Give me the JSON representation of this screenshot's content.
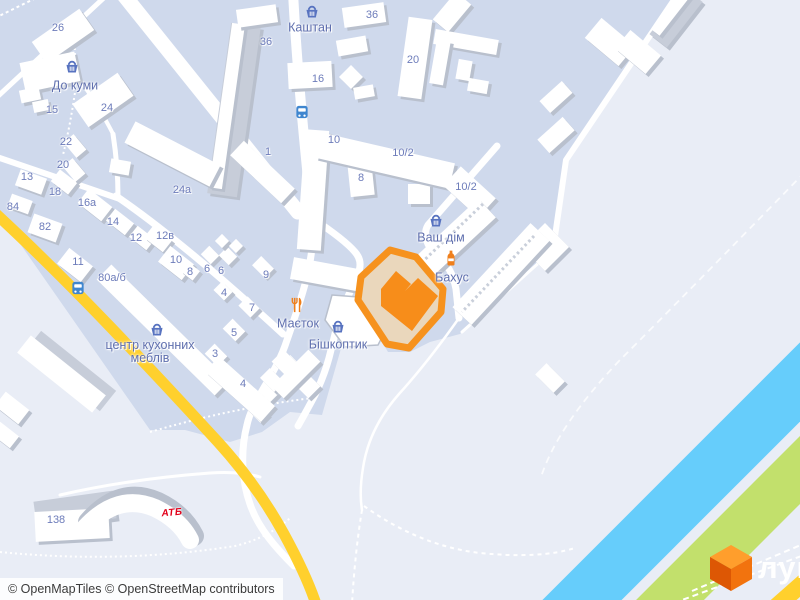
{
  "map": {
    "attribution": "© OpenMapTiles © OpenStreetMap contributors",
    "brand": {
      "logo_text": "лун",
      "logo_icon": "lun-cube-icon"
    },
    "colors": {
      "highlight_outline": "#f6921e",
      "highlight_building": "#f78d1a",
      "highlight_fill": "#ead7bc",
      "river": "#66cdfb",
      "greenery": "#c2e06c",
      "road_primary_yellow": "#ffd02d",
      "residential": "#cfd9ec",
      "background": "#e9edf6",
      "poi_blue": "#5873c0",
      "poi_orange": "#ef7f1b",
      "atb_red": "#e2001a"
    },
    "pois": [
      {
        "id": "kashtan",
        "lines": [
          "Каштан"
        ],
        "icon": "basket",
        "lx": 310,
        "ly": 28,
        "ix": 312,
        "iy": 12
      },
      {
        "id": "do-kumy",
        "lines": [
          "До куми"
        ],
        "icon": "basket",
        "lx": 75,
        "ly": 86,
        "ix": 72,
        "iy": 67
      },
      {
        "id": "vash-dim",
        "lines": [
          "Ваш дім"
        ],
        "icon": "basket",
        "lx": 441,
        "ly": 238,
        "ix": 436,
        "iy": 221
      },
      {
        "id": "bakhus",
        "lines": [
          "Бахус"
        ],
        "icon": "bottle",
        "lx": 452,
        "ly": 278,
        "ix": 451,
        "iy": 258
      },
      {
        "id": "maietok",
        "lines": [
          "Маєток"
        ],
        "icon": "restaurant",
        "lx": 298,
        "ly": 324,
        "ix": 297,
        "iy": 305
      },
      {
        "id": "bishkoptyk",
        "lines": [
          "Бішкоптик"
        ],
        "icon": "basket",
        "lx": 338,
        "ly": 345,
        "ix": 338,
        "iy": 327
      },
      {
        "id": "kitchen-center",
        "lines": [
          "центр кухонних",
          "меблів"
        ],
        "icon": "basket",
        "lx": 150,
        "ly": 352,
        "ix": 157,
        "iy": 330
      }
    ],
    "house_numbers": [
      {
        "t": "26",
        "x": 58,
        "y": 28
      },
      {
        "t": "36",
        "x": 266,
        "y": 42
      },
      {
        "t": "36",
        "x": 372,
        "y": 15
      },
      {
        "t": "24",
        "x": 107,
        "y": 108
      },
      {
        "t": "15",
        "x": 52,
        "y": 110
      },
      {
        "t": "16",
        "x": 318,
        "y": 79
      },
      {
        "t": "20",
        "x": 413,
        "y": 60
      },
      {
        "t": "10",
        "x": 334,
        "y": 140
      },
      {
        "t": "10/2",
        "x": 403,
        "y": 153
      },
      {
        "t": "10/2",
        "x": 466,
        "y": 187
      },
      {
        "t": "8",
        "x": 361,
        "y": 178
      },
      {
        "t": "22",
        "x": 66,
        "y": 142
      },
      {
        "t": "20",
        "x": 63,
        "y": 165
      },
      {
        "t": "13",
        "x": 27,
        "y": 177
      },
      {
        "t": "18",
        "x": 55,
        "y": 192
      },
      {
        "t": "16а",
        "x": 87,
        "y": 203
      },
      {
        "t": "84",
        "x": 13,
        "y": 207
      },
      {
        "t": "82",
        "x": 45,
        "y": 227
      },
      {
        "t": "14",
        "x": 113,
        "y": 222
      },
      {
        "t": "24а",
        "x": 182,
        "y": 190
      },
      {
        "t": "1",
        "x": 268,
        "y": 152
      },
      {
        "t": "12",
        "x": 136,
        "y": 238
      },
      {
        "t": "12в",
        "x": 165,
        "y": 236
      },
      {
        "t": "10",
        "x": 176,
        "y": 260
      },
      {
        "t": "11",
        "x": 78,
        "y": 262
      },
      {
        "t": "80а/б",
        "x": 112,
        "y": 278
      },
      {
        "t": "8",
        "x": 190,
        "y": 272
      },
      {
        "t": "6",
        "x": 207,
        "y": 269
      },
      {
        "t": "6",
        "x": 221,
        "y": 271
      },
      {
        "t": "9",
        "x": 266,
        "y": 275
      },
      {
        "t": "4",
        "x": 224,
        "y": 293
      },
      {
        "t": "7",
        "x": 252,
        "y": 308
      },
      {
        "t": "5",
        "x": 234,
        "y": 333
      },
      {
        "t": "3",
        "x": 215,
        "y": 354
      },
      {
        "t": "4",
        "x": 243,
        "y": 384
      },
      {
        "t": "138",
        "x": 56,
        "y": 520
      }
    ],
    "bus_stops": [
      {
        "x": 302,
        "y": 112
      },
      {
        "x": 78,
        "y": 288
      }
    ],
    "store_logos": [
      {
        "id": "atb",
        "label": "АТБ",
        "x": 172,
        "y": 513
      }
    ]
  }
}
